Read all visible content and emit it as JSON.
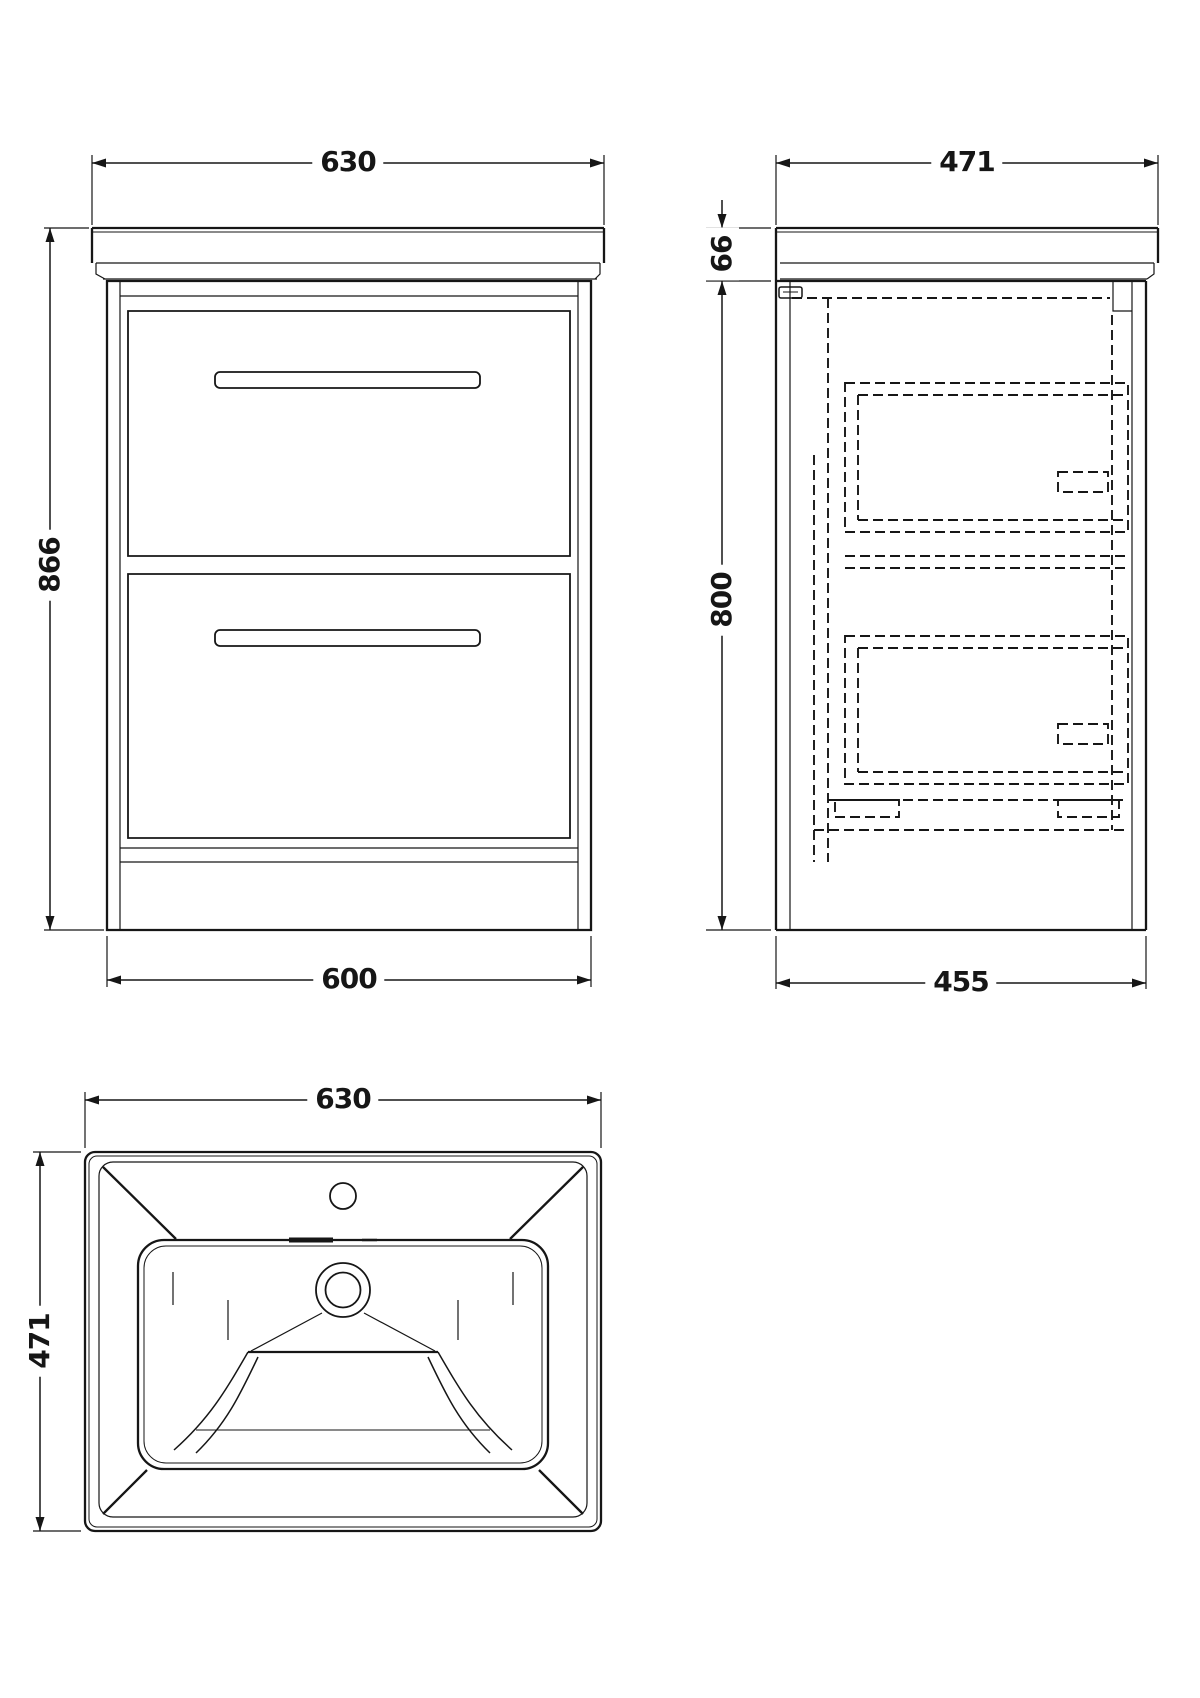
{
  "drawing": {
    "front_view": {
      "width_top": "630",
      "height": "866",
      "width_bottom": "600"
    },
    "side_view": {
      "depth_top": "471",
      "worktop_height": "66",
      "cabinet_height": "800",
      "depth_bottom": "455"
    },
    "plan_view": {
      "width": "630",
      "depth": "471"
    }
  },
  "colors": {
    "line": "#161616",
    "background": "#ffffff"
  }
}
